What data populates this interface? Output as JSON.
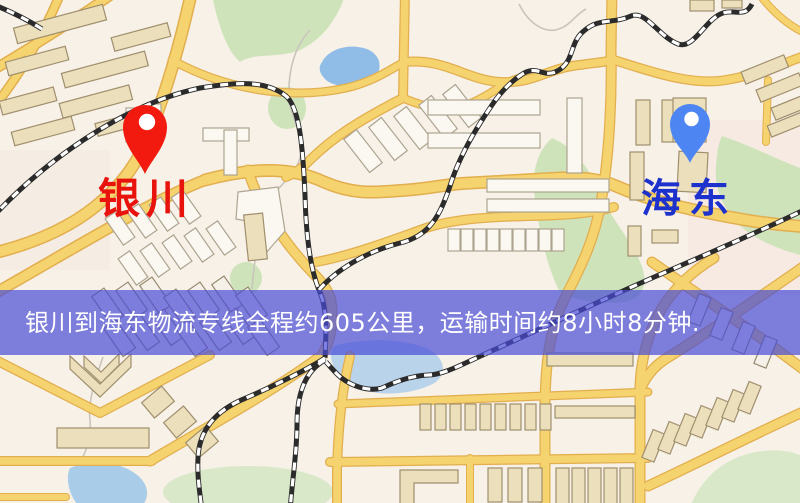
{
  "page": {
    "width": 800,
    "height": 503,
    "kind": "logistics-route-map"
  },
  "map": {
    "origin": {
      "name": "银川",
      "pin_color": "#f2190f",
      "label_color": "#e8130d"
    },
    "destination": {
      "name": "海东",
      "pin_color": "#4d86f2",
      "label_color": "#1d31cc"
    }
  },
  "banner": {
    "text": "银川到海东物流专线全程约605公里，运输时间约8小时8分钟.",
    "from": "银川",
    "to": "海东",
    "distance_text": "约605公里",
    "duration_text": "约8小时8分钟",
    "background_color": "rgba(72,76,215,0.70)",
    "text_color": "#ffffff"
  },
  "palette": {
    "map_background": "#f7f1e7",
    "road_fill": "#f5d36e",
    "road_casing": "#e2ae4e",
    "park_green": "#cfe3ba",
    "water_blue": "#8fbde8",
    "railway_dark": "#2b2b2b"
  }
}
